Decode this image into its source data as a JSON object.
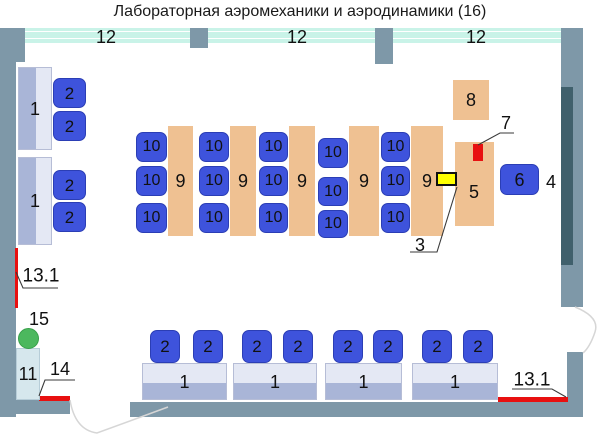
{
  "title": "Лабораторная аэромеханики и аэродинамики (16)",
  "colors": {
    "wall": "#7e98a8",
    "window": "#c9f3e8",
    "chair": "#3e53dc",
    "peach": "#efc192",
    "desklight": "#e4e8f4",
    "deskdark": "#a9b5d7",
    "palebox": "#d6e7ed",
    "green": "#4cb85e",
    "red": "#e81010",
    "yellow": "#ffff00",
    "darkbar": "#40606c"
  },
  "shapes": [
    {
      "n": "wall-left",
      "t": "wall",
      "x": 0,
      "y": 28,
      "w": 16,
      "h": 389
    },
    {
      "n": "wall-corner-topleft",
      "t": "wall",
      "x": 0,
      "y": 28,
      "w": 25,
      "h": 34
    },
    {
      "n": "wall-pillar-top-1",
      "t": "wall",
      "x": 190,
      "y": 28,
      "w": 18,
      "h": 20
    },
    {
      "n": "wall-pillar-top-2",
      "t": "wall",
      "x": 375,
      "y": 28,
      "w": 18,
      "h": 36
    },
    {
      "n": "wall-right-upper",
      "t": "wall",
      "x": 561,
      "y": 28,
      "w": 22,
      "h": 279
    },
    {
      "n": "wall-right-lower",
      "t": "wall",
      "x": 567,
      "y": 352,
      "w": 16,
      "h": 65
    },
    {
      "n": "wall-bottom-left",
      "t": "wall",
      "x": 0,
      "y": 399,
      "w": 70,
      "h": 15
    },
    {
      "n": "wall-bottom-right",
      "t": "wall",
      "x": 130,
      "y": 402,
      "w": 453,
      "h": 15
    },
    {
      "n": "window-1",
      "t": "window",
      "x": 25,
      "y": 28,
      "w": 165,
      "h": 15
    },
    {
      "n": "window-2",
      "t": "window",
      "x": 208,
      "y": 28,
      "w": 167,
      "h": 15
    },
    {
      "n": "window-3",
      "t": "window",
      "x": 393,
      "y": 28,
      "w": 168,
      "h": 15
    },
    {
      "n": "red-marked-line-13-1-left",
      "t": "redline",
      "x": 15,
      "y": 248,
      "w": 3,
      "h": 60
    },
    {
      "n": "red-marked-line-14",
      "t": "redline",
      "x": 39,
      "y": 396,
      "w": 31,
      "h": 5
    },
    {
      "n": "red-marked-line-13-1-right",
      "t": "redline",
      "x": 498,
      "y": 397,
      "w": 70,
      "h": 5
    },
    {
      "n": "wall-board-4",
      "t": "darkbar",
      "x": 561,
      "y": 87,
      "w": 12,
      "h": 178
    },
    {
      "n": "desk-1-left-a",
      "t": "vdesk",
      "x": 18,
      "y": 67,
      "w": 34,
      "h": 83,
      "text": "1"
    },
    {
      "n": "desk-1-left-b",
      "t": "vdesk",
      "x": 18,
      "y": 157,
      "w": 34,
      "h": 88,
      "text": "1"
    },
    {
      "n": "chair-2",
      "t": "chair",
      "x": 53,
      "y": 78,
      "w": 33,
      "h": 30,
      "text": "2",
      "fs": 17
    },
    {
      "n": "chair-2",
      "t": "chair",
      "x": 53,
      "y": 111,
      "w": 33,
      "h": 30,
      "text": "2",
      "fs": 17
    },
    {
      "n": "chair-2",
      "t": "chair",
      "x": 53,
      "y": 170,
      "w": 33,
      "h": 30,
      "text": "2",
      "fs": 17
    },
    {
      "n": "chair-2",
      "t": "chair",
      "x": 53,
      "y": 202,
      "w": 33,
      "h": 30,
      "text": "2",
      "fs": 17
    },
    {
      "n": "lab-bench-9",
      "t": "peach",
      "x": 168,
      "y": 126,
      "w": 25,
      "h": 110,
      "text": "9"
    },
    {
      "n": "lab-bench-9",
      "t": "peach",
      "x": 230,
      "y": 126,
      "w": 26,
      "h": 110,
      "text": "9"
    },
    {
      "n": "lab-bench-9",
      "t": "peach",
      "x": 289,
      "y": 126,
      "w": 26,
      "h": 110,
      "text": "9"
    },
    {
      "n": "lab-bench-9",
      "t": "peach",
      "x": 349,
      "y": 126,
      "w": 30,
      "h": 110,
      "text": "9"
    },
    {
      "n": "lab-bench-9",
      "t": "peach",
      "x": 411,
      "y": 126,
      "w": 32,
      "h": 110,
      "text": "9"
    },
    {
      "n": "stool-10",
      "t": "chair",
      "x": 136,
      "y": 132,
      "w": 31,
      "h": 30,
      "text": "10",
      "fs": 16
    },
    {
      "n": "stool-10",
      "t": "chair",
      "x": 136,
      "y": 166,
      "w": 31,
      "h": 30,
      "text": "10",
      "fs": 16
    },
    {
      "n": "stool-10",
      "t": "chair",
      "x": 136,
      "y": 203,
      "w": 31,
      "h": 30,
      "text": "10",
      "fs": 16
    },
    {
      "n": "stool-10",
      "t": "chair",
      "x": 199,
      "y": 132,
      "w": 30,
      "h": 30,
      "text": "10",
      "fs": 16
    },
    {
      "n": "stool-10",
      "t": "chair",
      "x": 199,
      "y": 166,
      "w": 30,
      "h": 30,
      "text": "10",
      "fs": 16
    },
    {
      "n": "stool-10",
      "t": "chair",
      "x": 199,
      "y": 203,
      "w": 30,
      "h": 30,
      "text": "10",
      "fs": 16
    },
    {
      "n": "stool-10",
      "t": "chair",
      "x": 259,
      "y": 132,
      "w": 29,
      "h": 30,
      "text": "10",
      "fs": 16
    },
    {
      "n": "stool-10",
      "t": "chair",
      "x": 259,
      "y": 166,
      "w": 29,
      "h": 30,
      "text": "10",
      "fs": 16
    },
    {
      "n": "stool-10",
      "t": "chair",
      "x": 259,
      "y": 203,
      "w": 29,
      "h": 30,
      "text": "10",
      "fs": 16
    },
    {
      "n": "stool-10",
      "t": "chair",
      "x": 318,
      "y": 138,
      "w": 30,
      "h": 30,
      "text": "10",
      "fs": 16
    },
    {
      "n": "stool-10",
      "t": "chair",
      "x": 318,
      "y": 177,
      "w": 30,
      "h": 29,
      "text": "10",
      "fs": 16
    },
    {
      "n": "stool-10",
      "t": "chair",
      "x": 318,
      "y": 210,
      "w": 30,
      "h": 28,
      "text": "10",
      "fs": 16
    },
    {
      "n": "stool-10",
      "t": "chair",
      "x": 381,
      "y": 132,
      "w": 29,
      "h": 30,
      "text": "10",
      "fs": 16
    },
    {
      "n": "stool-10",
      "t": "chair",
      "x": 381,
      "y": 166,
      "w": 29,
      "h": 30,
      "text": "10",
      "fs": 16
    },
    {
      "n": "stool-10",
      "t": "chair",
      "x": 381,
      "y": 203,
      "w": 29,
      "h": 30,
      "text": "10",
      "fs": 16
    },
    {
      "n": "cabinet-8",
      "t": "peach",
      "x": 453,
      "y": 80,
      "w": 36,
      "h": 40,
      "text": "8"
    },
    {
      "n": "equipment-table-5",
      "t": "peach",
      "x": 455,
      "y": 142,
      "w": 39,
      "h": 84
    },
    {
      "n": "device-7",
      "t": "redbox",
      "x": 473,
      "y": 144,
      "w": 10,
      "h": 17
    },
    {
      "n": "device-3",
      "t": "yellowbox",
      "x": 436,
      "y": 172,
      "w": 21,
      "h": 14
    },
    {
      "n": "chair-6",
      "t": "chair",
      "x": 500,
      "y": 164,
      "w": 39,
      "h": 31,
      "text": "6"
    },
    {
      "n": "student-desk-1",
      "t": "hdesk",
      "x": 142,
      "y": 363,
      "w": 85,
      "h": 37,
      "text": "1"
    },
    {
      "n": "student-desk-1",
      "t": "hdesk",
      "x": 233,
      "y": 363,
      "w": 84,
      "h": 37,
      "text": "1"
    },
    {
      "n": "student-desk-1",
      "t": "hdesk",
      "x": 325,
      "y": 363,
      "w": 77,
      "h": 37,
      "text": "1"
    },
    {
      "n": "student-desk-1",
      "t": "hdesk",
      "x": 412,
      "y": 363,
      "w": 86,
      "h": 37,
      "text": "1"
    },
    {
      "n": "chair-2",
      "t": "chair",
      "x": 150,
      "y": 330,
      "w": 30,
      "h": 33,
      "text": "2",
      "fs": 17
    },
    {
      "n": "chair-2",
      "t": "chair",
      "x": 193,
      "y": 330,
      "w": 30,
      "h": 33,
      "text": "2",
      "fs": 17
    },
    {
      "n": "chair-2",
      "t": "chair",
      "x": 242,
      "y": 330,
      "w": 30,
      "h": 33,
      "text": "2",
      "fs": 17
    },
    {
      "n": "chair-2",
      "t": "chair",
      "x": 283,
      "y": 330,
      "w": 30,
      "h": 33,
      "text": "2",
      "fs": 17
    },
    {
      "n": "chair-2",
      "t": "chair",
      "x": 333,
      "y": 330,
      "w": 30,
      "h": 33,
      "text": "2",
      "fs": 17
    },
    {
      "n": "chair-2",
      "t": "chair",
      "x": 373,
      "y": 330,
      "w": 30,
      "h": 33,
      "text": "2",
      "fs": 17
    },
    {
      "n": "chair-2",
      "t": "chair",
      "x": 422,
      "y": 330,
      "w": 30,
      "h": 33,
      "text": "2",
      "fs": 17
    },
    {
      "n": "chair-2",
      "t": "chair",
      "x": 463,
      "y": 330,
      "w": 30,
      "h": 33,
      "text": "2",
      "fs": 17
    },
    {
      "n": "cabinet-11",
      "t": "palebox",
      "x": 16,
      "y": 348,
      "w": 24,
      "h": 52,
      "text": "11"
    },
    {
      "n": "marker-15",
      "t": "circle",
      "x": 18,
      "y": 328,
      "w": 21,
      "h": 21
    },
    {
      "n": "window-label-12",
      "t": "label",
      "x": 106,
      "y": 37,
      "text": "12"
    },
    {
      "n": "window-label-12",
      "t": "label",
      "x": 297,
      "y": 37,
      "text": "12"
    },
    {
      "n": "window-label-12",
      "t": "label",
      "x": 476,
      "y": 37,
      "text": "12"
    },
    {
      "n": "label-5",
      "t": "label",
      "x": 474,
      "y": 192,
      "text": "5"
    },
    {
      "n": "label-7",
      "t": "label",
      "x": 506,
      "y": 123,
      "text": "7"
    },
    {
      "n": "label-4",
      "t": "label",
      "x": 551,
      "y": 182,
      "text": "4"
    },
    {
      "n": "label-3",
      "t": "label",
      "x": 420,
      "y": 245,
      "text": "3"
    },
    {
      "n": "label-15",
      "t": "label",
      "x": 39,
      "y": 319,
      "text": "15"
    },
    {
      "n": "label-14",
      "t": "label",
      "x": 60,
      "y": 369,
      "text": "14"
    },
    {
      "n": "label-13-1-left",
      "t": "label",
      "x": 41,
      "y": 276,
      "text": "13.1",
      "fs": 19
    },
    {
      "n": "label-13-1-right",
      "t": "label",
      "x": 532,
      "y": 380,
      "text": "13.1",
      "fs": 19
    }
  ],
  "lines": [
    {
      "n": "leader-7",
      "t": "leader",
      "d": "M478,145 L500,133 L514,133"
    },
    {
      "n": "leader-3",
      "t": "leader",
      "d": "M457,187 L437,252 L410,252"
    },
    {
      "n": "leader-13-1-left",
      "t": "leader",
      "d": "M16,272 L23,288 L58,288"
    },
    {
      "n": "leader-14",
      "t": "leader",
      "d": "M39,396 L45,380 L75,380"
    },
    {
      "n": "leader-13-1-right",
      "t": "leader",
      "d": "M512,389 L552,389 L566,397"
    },
    {
      "n": "door-arc-bottom",
      "t": "door",
      "d": "M70,400 Q75,430 97,433 L168,407"
    },
    {
      "n": "door-arc-right",
      "t": "door",
      "d": "M575,307 Q600,317 595,332 Q590,347 583,353"
    }
  ]
}
